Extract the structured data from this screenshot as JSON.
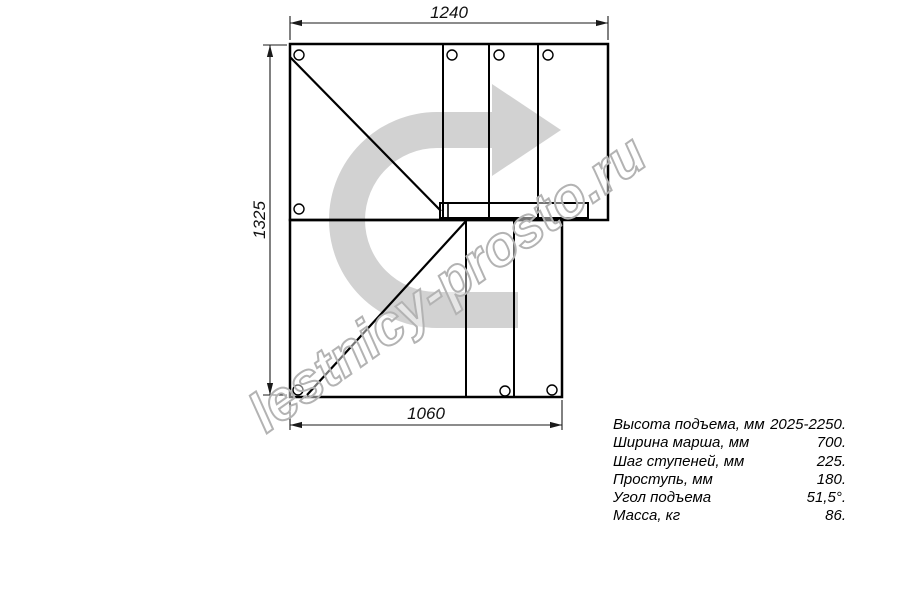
{
  "drawing": {
    "title": "stair-plan-top-view",
    "dimensions": {
      "top_width_mm": "1240",
      "left_height_mm": "1325",
      "bottom_width_mm": "1060"
    },
    "icons": {
      "direction_arrow": "u-turn-right-arrow"
    },
    "watermark": "lestnicy-prosto.ru"
  },
  "specs": {
    "rows": [
      {
        "label": "Высота подъема, мм",
        "value": "2025-2250."
      },
      {
        "label": "Ширина марша, мм",
        "value": "700."
      },
      {
        "label": "Шаг ступеней, мм",
        "value": "225."
      },
      {
        "label": "Проступь, мм",
        "value": "180."
      },
      {
        "label": "Угол подъема",
        "value": "51,5°."
      },
      {
        "label": "Масса, кг",
        "value": "86."
      }
    ]
  },
  "colors": {
    "line": "#000000",
    "dimension_line": "#1a1a1a",
    "direction_arrow_fill": "#d2d2d2",
    "watermark_stroke": "#b3b3b3"
  }
}
